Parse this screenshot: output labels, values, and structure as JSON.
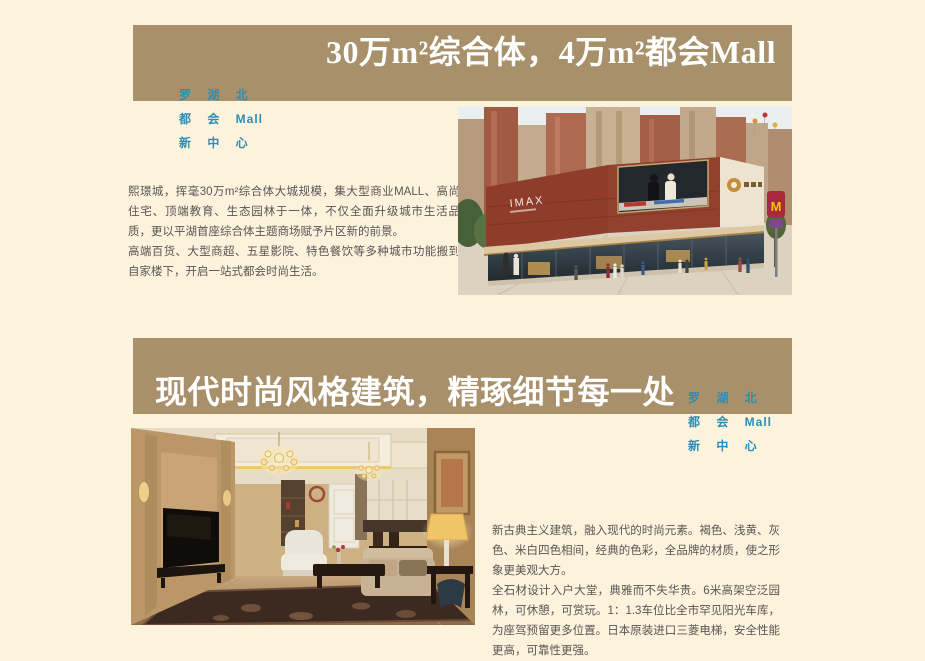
{
  "theme": {
    "background": "#fcf3dd",
    "panel_tan": "#a8906a",
    "accent_blue": "#2d8db4",
    "title_white": "#ffffff",
    "body_text": "#5c5454"
  },
  "brand": {
    "line1": "罗 湖 北",
    "line2": "都 会 Mall",
    "line3": "新 中 心"
  },
  "section_mall": {
    "title": "30万m²综合体，4万m²都会Mall",
    "paragraph1": "熙璟城，挥毫30万m²综合体大城规模，集大型商业MALL、高尚住宅、顶端教育、生态园林于一体，不仅全面升级城市生活品质，更以平湖首座综合体主题商场赋予片区新的前景。",
    "paragraph2": "高端百货、大型商超、五星影院、特色餐饮等多种城市功能搬到自家楼下，开启一站式都会时尚生活。",
    "image_labels": {
      "imax": "IMAX",
      "m_sign": "M"
    }
  },
  "section_interior": {
    "title": "现代时尚风格建筑，精琢细节每一处",
    "paragraph1": "新古典主义建筑，融入现代的时尚元素。褐色、浅黄、灰色、米白四色相间，经典的色彩，全品牌的材质，使之形象更美观大方。",
    "paragraph2": "全石材设计入户大堂，典雅而不失华贵。6米高架空泛园林，可休憩，可赏玩。1：1.3车位比全市罕见阳光车库，为座驾预留更多位置。日本原装进口三菱电梯，安全性能更高，可靠性更强。"
  }
}
